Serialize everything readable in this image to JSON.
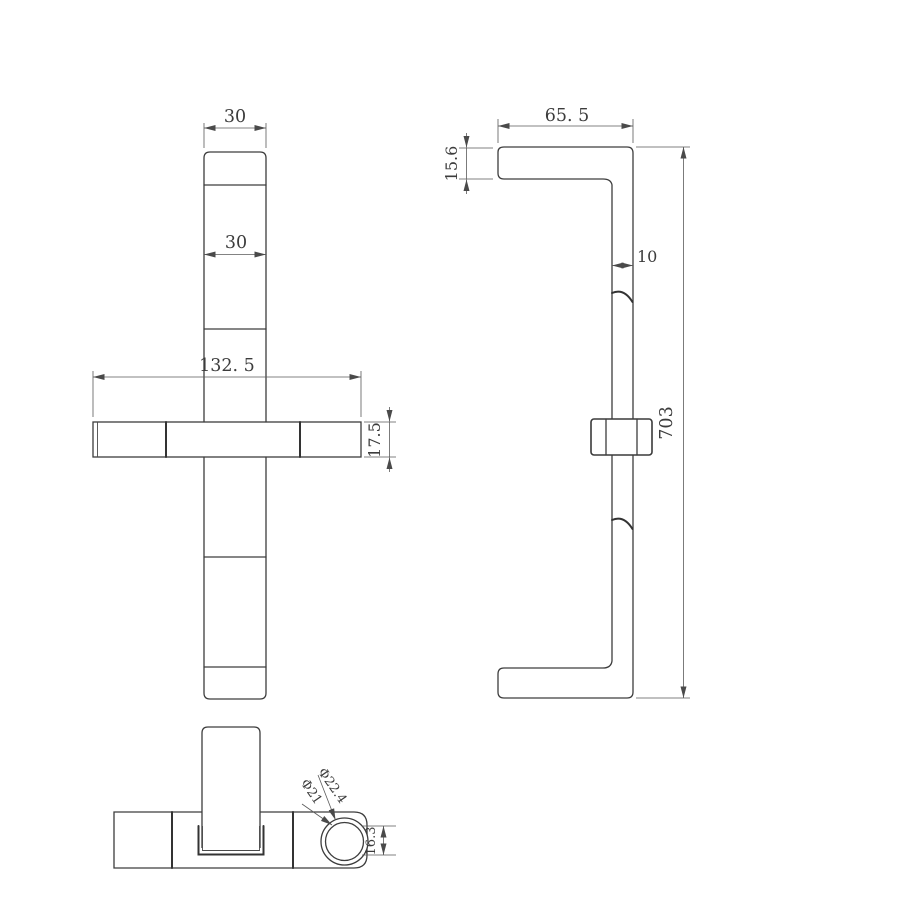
{
  "drawing": {
    "background": "#ffffff",
    "line_color": "#3d3d3d",
    "dim_color": "#5a5a5a",
    "front_view": {
      "dim_top_width": "30",
      "dim_bar_width": "30",
      "dim_rail_length": "132. 5",
      "dim_rail_height": "17.5"
    },
    "side_view": {
      "dim_bracket_length": "65. 5",
      "dim_bracket_height": "15.6",
      "dim_bar_depth": "10",
      "dim_total_height": "703"
    },
    "bottom_view": {
      "dim_outer_diameter": "Φ22.4",
      "dim_inner_diameter": "Φ21",
      "dim_cradle_height": "16.3"
    }
  }
}
